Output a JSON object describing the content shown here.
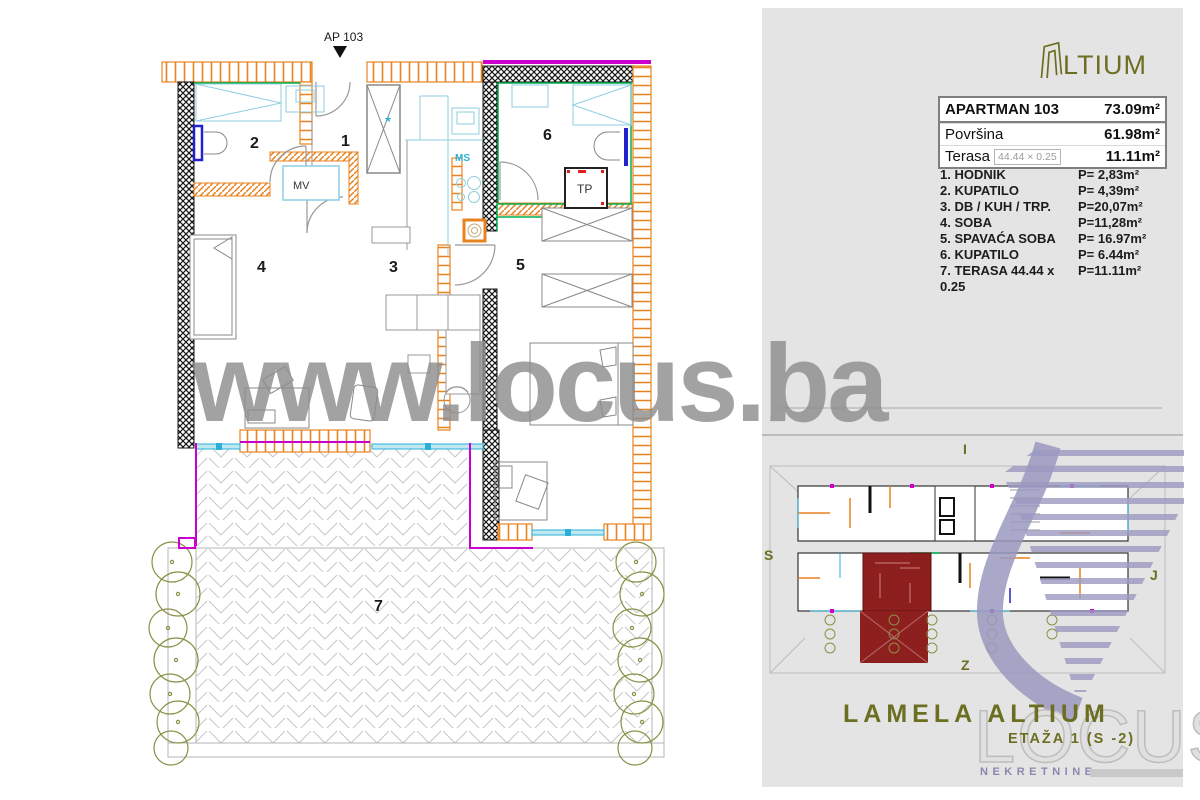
{
  "branding": {
    "altium_logo_text": "LTIUM",
    "watermark": "www.locus.ba",
    "lamela_title": "LAMELA ALTIUM",
    "etaza": "ETAŽA 1 (S -2)",
    "locus": "LOCUS",
    "nekretnine": "NEKRETNINE"
  },
  "apartment": {
    "entrance_label": "AP 103",
    "table": {
      "title": "APARTMAN 103",
      "title_value": "73.09m²",
      "rows": [
        {
          "label": "Površina",
          "value": "61.98m²"
        },
        {
          "label": "Terasa",
          "note": "44.44 × 0.25",
          "value": "11.11m²"
        }
      ]
    },
    "rooms": [
      {
        "label": "1. HODNIK",
        "area": "P= 2,83m²"
      },
      {
        "label": "2. KUPATILO",
        "area": "P= 4,39m²"
      },
      {
        "label": "3. DB / KUH / TRP.",
        "area": "P=20,07m²"
      },
      {
        "label": "4. SOBA",
        "area": "P=11,28m²"
      },
      {
        "label": "5. SPAVAĆA SOBA",
        "area": "P= 16.97m²"
      },
      {
        "label": "6. KUPATILO",
        "area": "P= 6.44m²"
      },
      {
        "label": "7. TERASA 44.44 x 0.25",
        "area": "P=11.11m²"
      }
    ]
  },
  "plan": {
    "room_numbers": {
      "r1": "1",
      "r2": "2",
      "r3": "3",
      "r4": "4",
      "r5": "5",
      "r6": "6",
      "r7": "7"
    },
    "labels": {
      "mv": "MV",
      "ms": "MS",
      "tp": "TP",
      "star": "★"
    }
  },
  "siteplan": {
    "compass": {
      "top": "I",
      "left": "S",
      "right": "J",
      "bottom": "Z"
    }
  },
  "colors": {
    "olive": "#6c6f22",
    "orange": "#e8821e",
    "magenta": "#cc00cc",
    "cyan": "#2ab0d8",
    "green": "#00b050",
    "unit_red": "#8e1f1f",
    "logo_purple": "#9b99bf",
    "watermark_gray": "#8c8c8c"
  }
}
